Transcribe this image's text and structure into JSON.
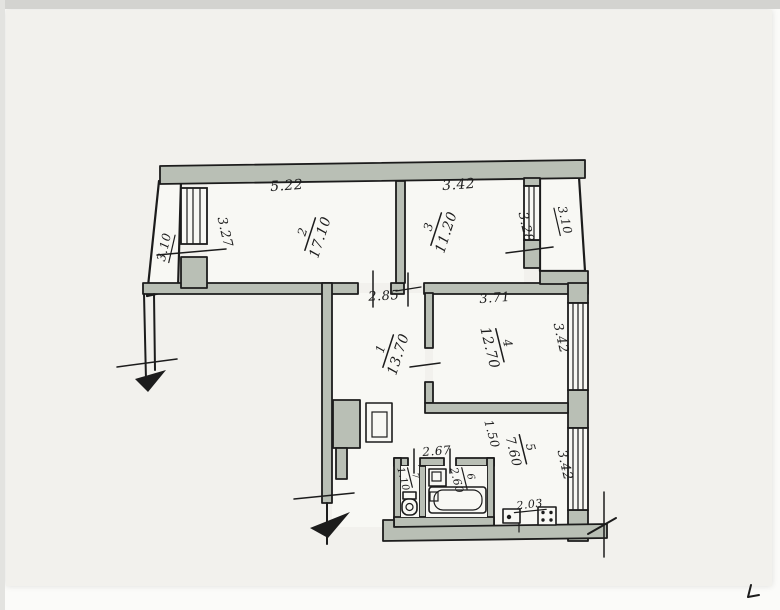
{
  "document": {
    "kind": "scanned hand-drawn apartment floor plan"
  },
  "colors": {
    "paper": "#f2f1ed",
    "room_interior": "#f8f8f4",
    "wall_fill": "#b9bfb5",
    "line": "#1c1c1c",
    "text": "#1d1d1d"
  },
  "rooms": {
    "hall": {
      "number": "1",
      "area": "13.70",
      "width": "2.85"
    },
    "living": {
      "number": "2",
      "area": "17.10",
      "width": "5.22",
      "depth": "3.27"
    },
    "bedroom": {
      "number": "3",
      "area": "11.20",
      "width": "3.42",
      "depth": "3.28"
    },
    "bedroom2": {
      "number": "4",
      "area": "12.70",
      "width": "3.71",
      "window": "3.42"
    },
    "kitchen": {
      "number": "5",
      "area": "7.60",
      "window": "3.42",
      "passage": "1.50",
      "counter": "2.03"
    },
    "bathroom": {
      "number": "6",
      "area": "2.60",
      "width": "2.67"
    },
    "wc": {
      "number": "7",
      "area": "1.10"
    }
  },
  "balconies": {
    "left": {
      "width": "3.10"
    },
    "right": {
      "width": "3.10"
    }
  },
  "fixtures": {
    "wc": "toilet",
    "bath": "bathtub",
    "basin": "washbasin",
    "kitchen_sink": "kitchen-sink",
    "kitchen_stove": "stove"
  }
}
